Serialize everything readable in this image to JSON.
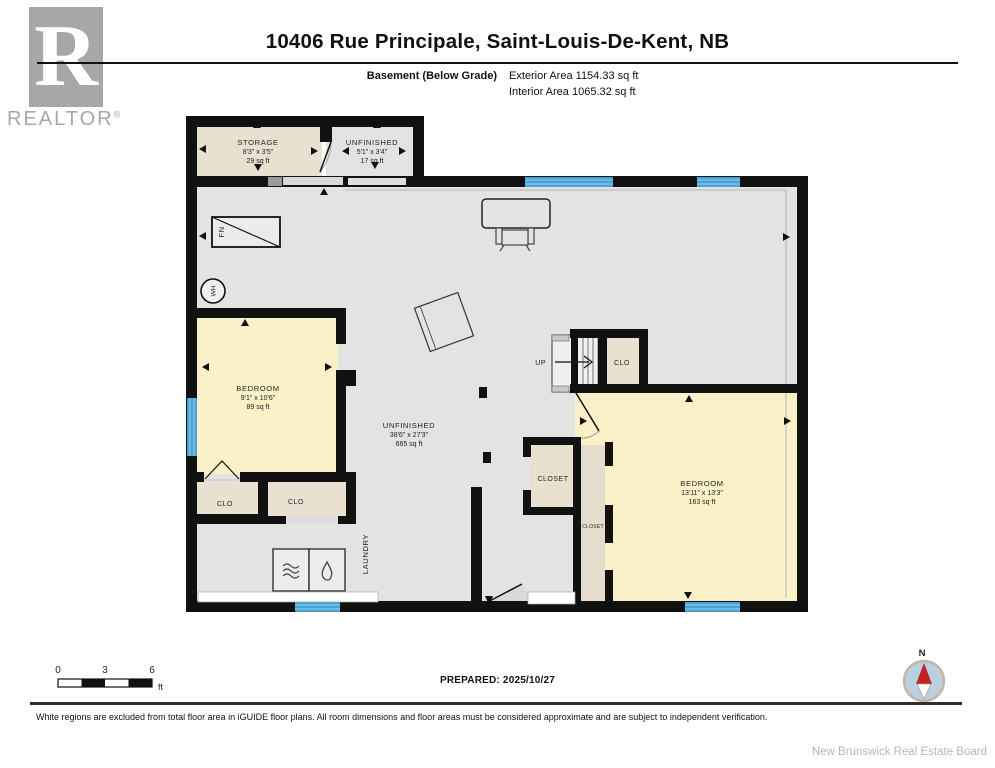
{
  "header": {
    "logo_r": "R",
    "logo_text": "REALTOR",
    "logo_reg": "®",
    "title": "10406 Rue Principale, Saint-Louis-De-Kent, NB",
    "floor_label": "Basement (Below Grade)",
    "exterior_area": "Exterior Area 1154.33 sq ft",
    "interior_area": "Interior Area 1065.32 sq ft"
  },
  "plan": {
    "rooms": [
      {
        "name": "STORAGE",
        "dims": "8'3\" x 3'5\"",
        "area": "29 sq ft"
      },
      {
        "name": "UNFINISHED",
        "dims": "5'1\" x 3'4\"",
        "area": "17 sq ft"
      },
      {
        "name": "BEDROOM",
        "dims": "9'1\" x 10'6\"",
        "area": "89 sq ft"
      },
      {
        "name": "UNFINISHED",
        "dims": "38'6\" x 27'3\"",
        "area": "665 sq ft"
      },
      {
        "name": "BEDROOM",
        "dims": "13'11\" x 13'3\"",
        "area": "163 sq ft"
      }
    ],
    "closets": {
      "clo_left_1": "CLO",
      "clo_left_2": "CLO",
      "clo_stairs": "CLO",
      "closet_small": "CLOSET",
      "closet_narrow": "CLOSET"
    },
    "labels": {
      "up": "UP",
      "laundry": "LAUNDRY",
      "furnace": "FN",
      "water_heater": "WH"
    },
    "colors": {
      "wall": "#111111",
      "floor_gray": "#e3e3e3",
      "room_yellow": "#faf1c8",
      "room_tan": "#eae0d0",
      "window_blue": "#45a4d4",
      "compass_red": "#c32222",
      "compass_blue": "#b9cfe2"
    }
  },
  "footer": {
    "scale_ticks": [
      "0",
      "3",
      "6"
    ],
    "scale_unit": "ft",
    "prepared": "PREPARED: 2025/10/27",
    "compass_north": "N",
    "disclaimer": "White regions are excluded from total floor area in iGUIDE floor plans. All room dimensions and floor areas must be considered approximate and are subject to independent verification.",
    "board": "New Brunswick Real Estate Board"
  }
}
